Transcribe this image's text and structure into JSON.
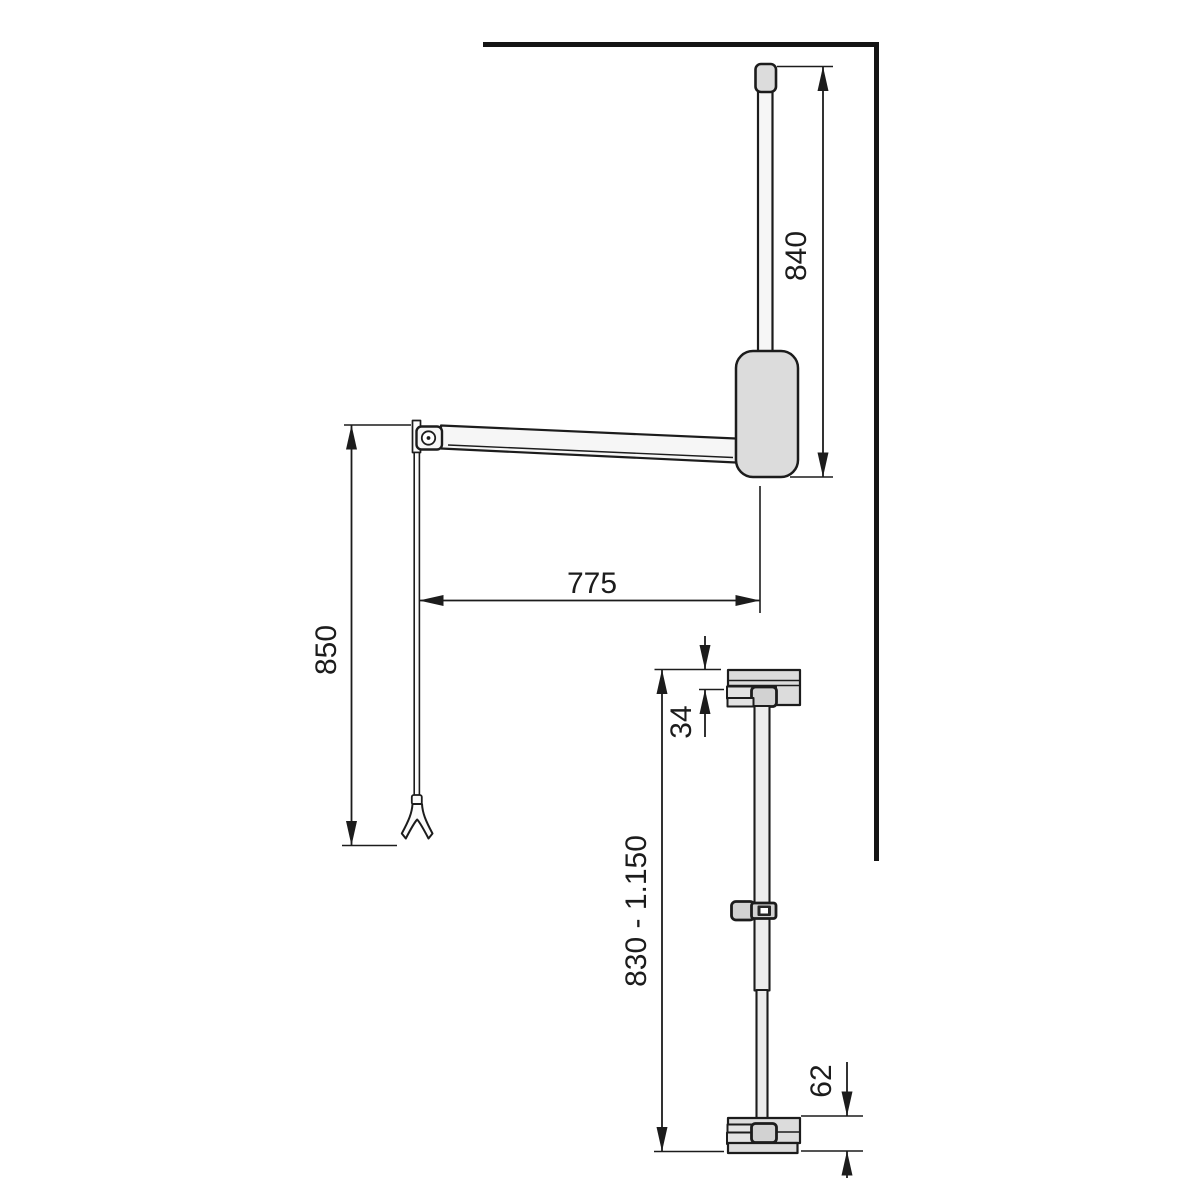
{
  "diagram": {
    "kind": "technical-dimension-drawing",
    "subject": "pull-down wardrobe lift rail, front view and side view with cabinet wall",
    "colors": {
      "line": "#1c1c1c",
      "object_fill": "#f6f6f6",
      "shaded_fill": "#dcdcdc",
      "background": "#ffffff"
    },
    "dimensions": {
      "rod_height": "840",
      "arm_reach": "775",
      "handle_drop": "850",
      "bracket_offset": "34",
      "mount_height_range": "830 - 1.150",
      "base_unit_height": "62"
    }
  }
}
